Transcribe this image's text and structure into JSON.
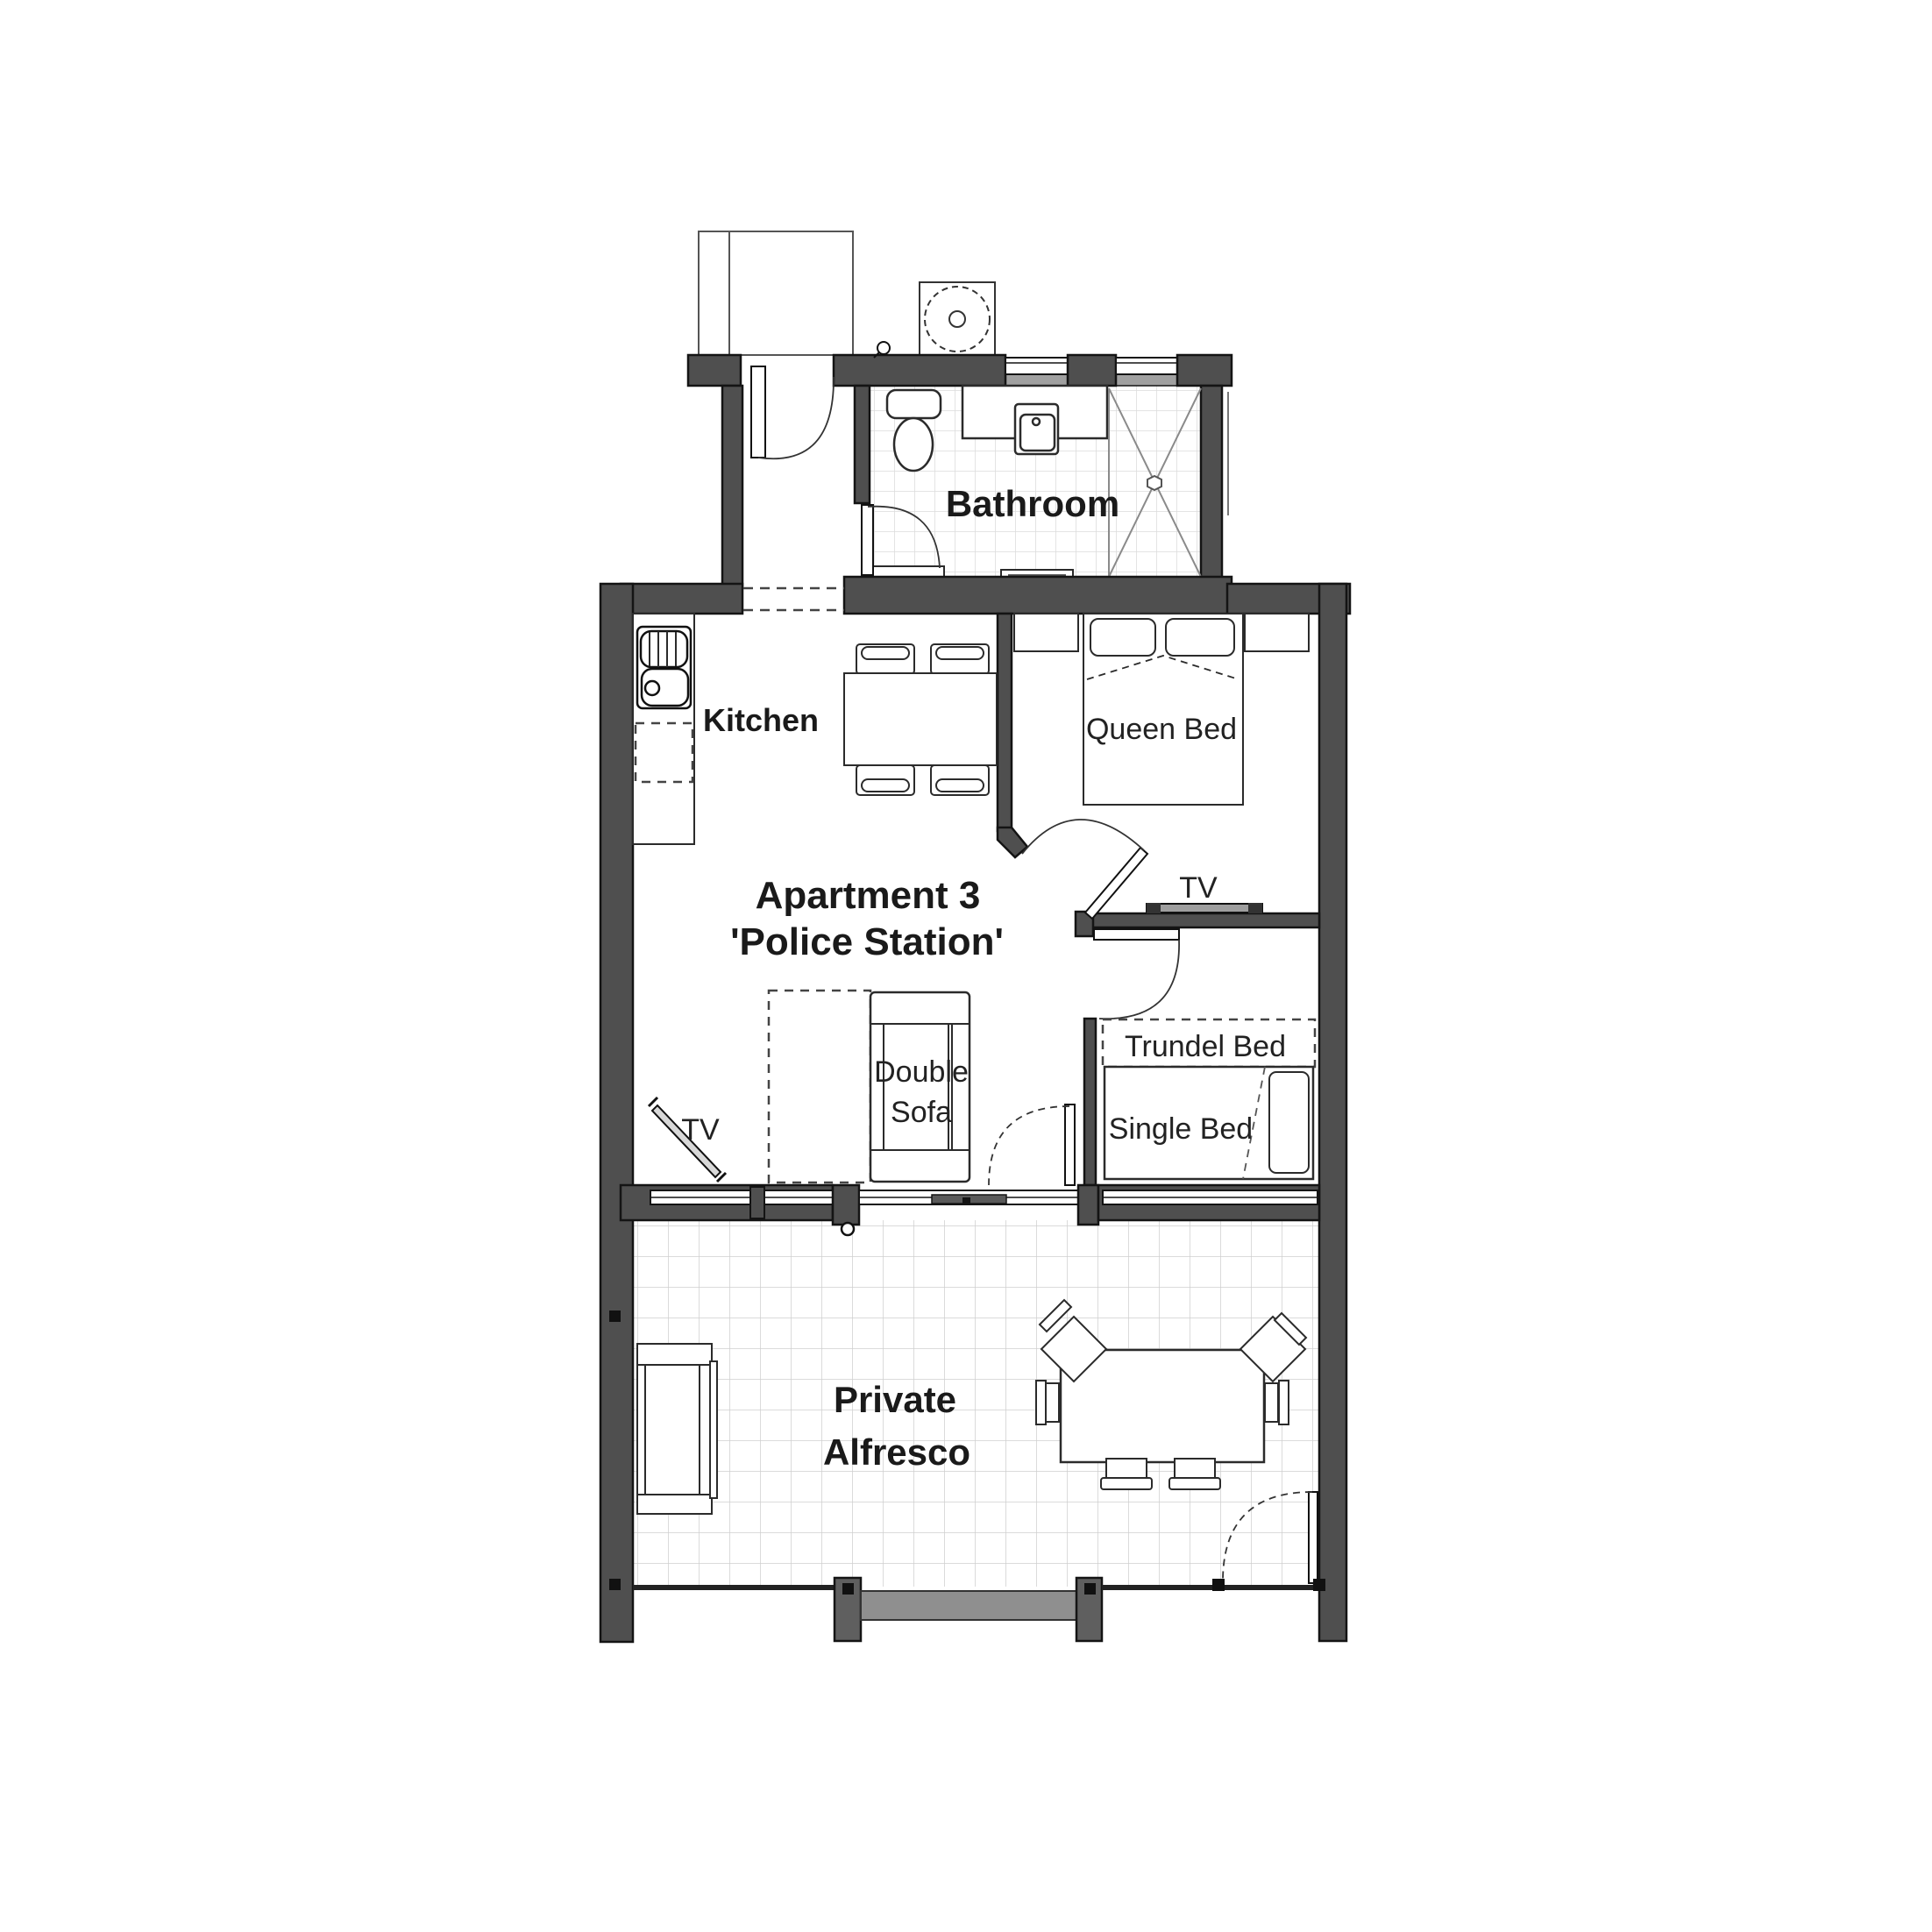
{
  "title": {
    "line1": "Apartment 3",
    "line2": "'Police Station'"
  },
  "rooms": {
    "bathroom": "Bathroom",
    "kitchen": "Kitchen",
    "alfresco_line1": "Private",
    "alfresco_line2": "Alfresco"
  },
  "furniture_labels": {
    "queen_bed": "Queen Bed",
    "tv_bedroom": "TV",
    "tv_living": "TV",
    "double_sofa_line1": "Double",
    "double_sofa_line2": "Sofa",
    "trundel_bed": "Trundel Bed",
    "single_bed": "Single Bed"
  },
  "colors": {
    "wall": "#4f4f4f",
    "wall_outline": "#141414",
    "window_sill": "#a0a0a0",
    "step": "#8f8f8f",
    "post": "#5f5f5f",
    "bath_tile_line": "#dcdcdc",
    "alfresco_tile_line": "#cfcfcf",
    "furniture_line": "#2b2b2b",
    "text": "#1a1a1a",
    "background": "#ffffff"
  }
}
